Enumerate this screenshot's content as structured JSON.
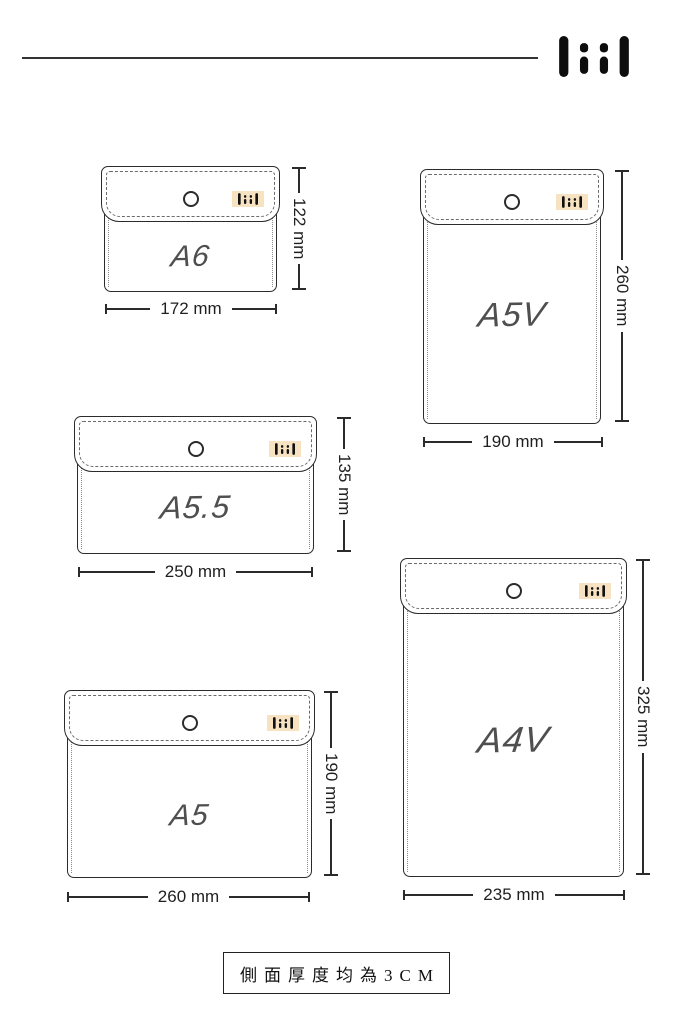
{
  "header": {
    "brand_logo_name": "liil"
  },
  "pouches": [
    {
      "name": "A6",
      "width_label": "172 mm",
      "height_label": "122 mm",
      "orientation": "landscape"
    },
    {
      "name": "A5V",
      "width_label": "190 mm",
      "height_label": "260 mm",
      "orientation": "portrait"
    },
    {
      "name": "A5.5",
      "width_label": "250 mm",
      "height_label": "135 mm",
      "orientation": "landscape"
    },
    {
      "name": "A5",
      "width_label": "260 mm",
      "height_label": "190 mm",
      "orientation": "landscape"
    },
    {
      "name": "A4V",
      "width_label": "235 mm",
      "height_label": "325 mm",
      "orientation": "portrait"
    }
  ],
  "note": {
    "text": "側面厚度均為3CM"
  },
  "icons": {
    "brand_logo": "liil-bars-logo",
    "snap": "snap-button",
    "label": "brand-fabric-label"
  },
  "colors": {
    "outline": "#2b2b2b",
    "label_bg": "#f7e3c2",
    "name_text": "#4f4f4f",
    "stitch": "#6a6a6a"
  }
}
